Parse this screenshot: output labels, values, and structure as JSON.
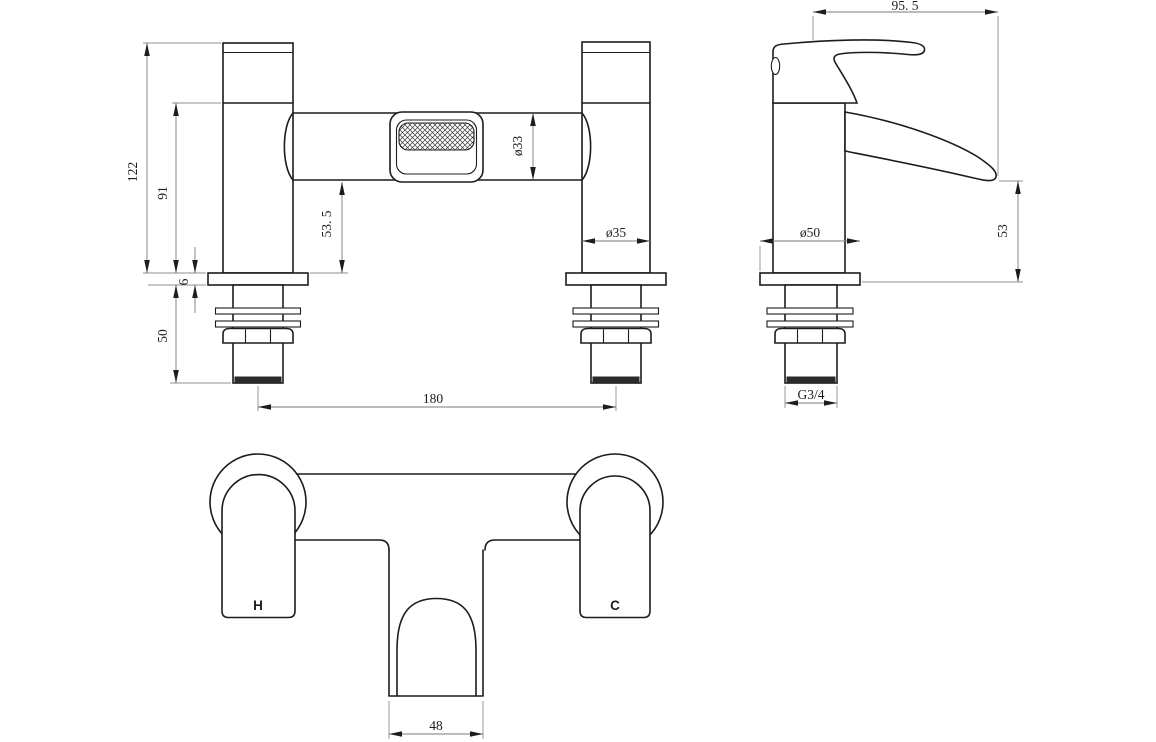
{
  "colors": {
    "background": "#ffffff",
    "object_line": "#1c1c1c",
    "dimension_line": "#7a7a7a",
    "text": "#1d1d1d",
    "thread_band": "#2b2b2b"
  },
  "front_view": {
    "dimensions": {
      "total_height": "122",
      "body_height": "91",
      "spout_clearance": "53. 5",
      "deck_plate_thickness": "6",
      "shank_length": "50",
      "tap_hole_centres": "180",
      "body_diameter": "ø33",
      "pillar_diameter": "ø35"
    }
  },
  "side_view": {
    "dimensions": {
      "spout_projection": "95. 5",
      "base_diameter": "ø50",
      "spout_height": "53",
      "inlet_thread": "G3/4"
    }
  },
  "top_view": {
    "labels": {
      "hot": "H",
      "cold": "C"
    },
    "dimensions": {
      "spout_width": "48"
    }
  }
}
